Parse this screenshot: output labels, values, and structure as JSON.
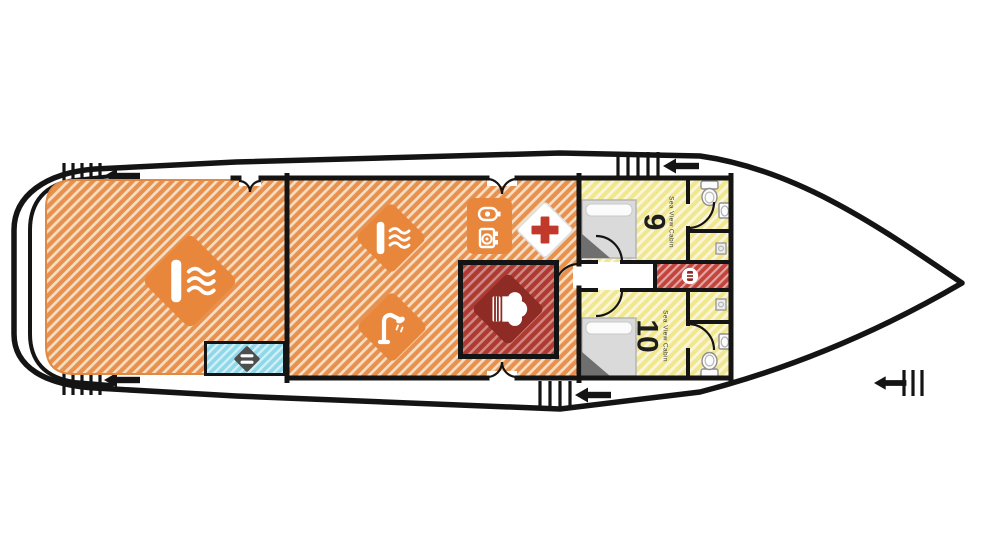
{
  "plan": {
    "type": "yacht-deck-floor-plan",
    "cabins": [
      {
        "number": "9",
        "label": "Sea View Cabin"
      },
      {
        "number": "10",
        "label": "Sea View Cabin"
      }
    ],
    "icons": {
      "aft_deck": "lounge-waves-icon",
      "salon_top": "lounge-waves-icon",
      "salon_bottom": "deck-shower-icon",
      "electronics_badge": [
        "power-icon",
        "camera-icon"
      ],
      "first_aid": "first-aid-cross-icon",
      "galley": "chef-hat-icon",
      "corridor": "stairs-icon",
      "swim_platform": "ladder-icon",
      "boarding": "left-arrow-icon"
    },
    "colors": {
      "ink": "#141414",
      "hull_fill": "#ffffff",
      "orange_base": "#E8914E",
      "orange_stripe": "#F6DFC5",
      "orange_solid": "#E8873B",
      "orange_edge": "#DE8A44",
      "yellow_base": "#F0E78E",
      "yellow_stripe": "#FAF6DC",
      "red_base": "#AE3A32",
      "red_dark": "#8D2B24",
      "corridor_red": "#C2443C",
      "cyan_base": "#8ED8E9",
      "cross_red": "#C0392B",
      "bed_gray": "#DADADA",
      "bed_fold": "#6F6F6F",
      "fixture_stroke": "#8F8F8F"
    }
  }
}
